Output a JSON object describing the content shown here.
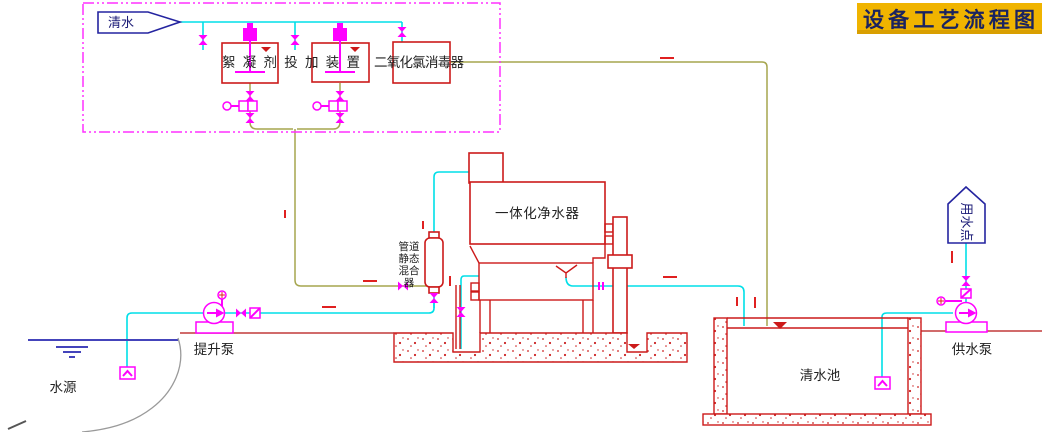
{
  "banner": {
    "title": "设备工艺流程图"
  },
  "labels": {
    "source_tag": "清水",
    "dosing_device": "絮凝剂投加装置",
    "disinfector": "二氧化氯消毒器",
    "purifier": "一体化净水器",
    "mixer_rows": [
      "管道",
      "静态",
      "混合",
      "器"
    ],
    "lift_pump": "提升泵",
    "water_source": "水源",
    "clear_water_pool": "清水池",
    "supply_pump": "供水泵",
    "use_point": "用水点"
  },
  "colors": {
    "banner_bg": "#F0B400",
    "banner_fg": "#1A2360",
    "water_pipe": "#00DFE8",
    "dosing_pipe": "#A6A64F",
    "equipment": "#CC1A1A",
    "fittings": "#FF00FF",
    "annotation": "#2424A0",
    "flow_arrow": "#E02020"
  }
}
